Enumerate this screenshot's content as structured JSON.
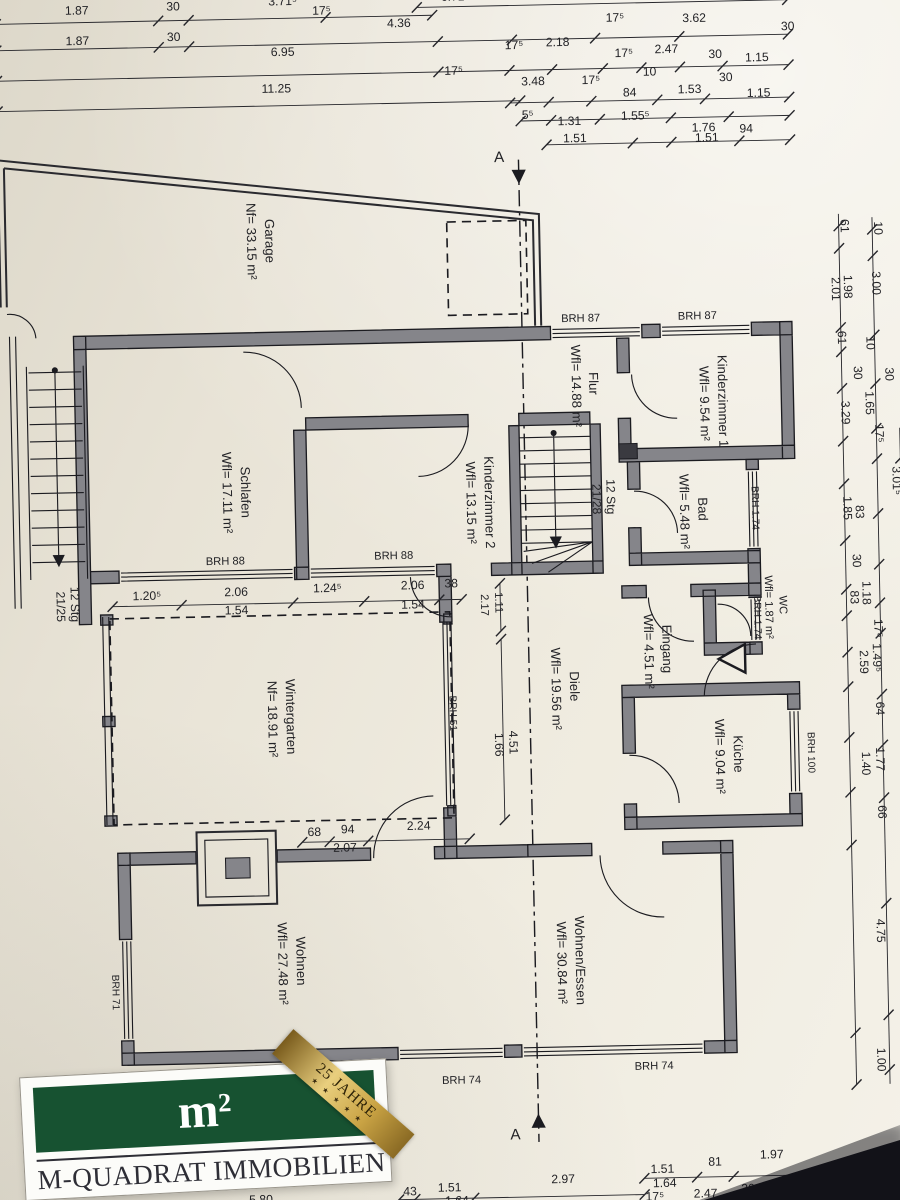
{
  "meta": {
    "paper_color": "#efebdf",
    "ink_color": "#1b1b20",
    "wall_fill": "#85858a",
    "corner_shadow": "#121218",
    "logo_green": "#175231",
    "logo_gold": "#c9a344"
  },
  "logo": {
    "m": "m",
    "sup": "2",
    "company": "M-QUADRAT IMMOBILIEN",
    "ribbon_line1": "25 JAHRE",
    "ribbon_stars": "★ ★ ★ ★ ★"
  },
  "rooms": [
    {
      "name": "Garage",
      "area": "Nf= 33.15 m²"
    },
    {
      "name": "Schlafen",
      "area": "Wfl= 17.11 m²"
    },
    {
      "name": "Kinderzimmer 2",
      "area": "Wfl= 13.15 m²"
    },
    {
      "name": "Kinderzimmer 1",
      "area": "Wfl= 9.54 m²"
    },
    {
      "name": "Flur",
      "area": "Wfl= 14.88 m²"
    },
    {
      "name": "Bad",
      "area": "Wfl= 5.48 m²"
    },
    {
      "name": "WC",
      "area": "Wfl= 1.87 m²"
    },
    {
      "name": "Eingang",
      "area": "Wfl= 4.51 m²"
    },
    {
      "name": "Diele",
      "area": "Wfl= 19.56 m²"
    },
    {
      "name": "Küche",
      "area": "Wfl= 9.04 m²"
    },
    {
      "name": "Wintergarten",
      "area": "Nf= 18.91 m²"
    },
    {
      "name": "Wohnen",
      "area": "Wfl= 27.48 m²"
    },
    {
      "name": "Wohnen/Essen",
      "area": "Wfl= 30.84 m²"
    }
  ],
  "stairs": [
    {
      "label": "12 Stg",
      "ratio": "21/25"
    },
    {
      "label": "12 Stg",
      "ratio": "21/28"
    }
  ],
  "section_marker": "A",
  "annotations": [
    [
      "dim-top",
      "1.87",
      95,
      16
    ],
    [
      "dim-top",
      "30",
      190,
      14
    ],
    [
      "dim-top",
      "3.71⁵",
      298,
      11
    ],
    [
      "dim-top",
      "17⁵",
      336,
      21
    ],
    [
      "dim-top",
      "6.71⁵",
      468,
      10
    ],
    [
      "dim-top",
      "3.62",
      665,
      7
    ],
    [
      "dim-top",
      "1.87",
      95,
      46
    ],
    [
      "dim-top",
      "30",
      190,
      44
    ],
    [
      "dim-top",
      "4.36",
      412,
      35
    ],
    [
      "dim-top",
      "17⁵",
      625,
      34
    ],
    [
      "dim-top",
      "3.62",
      703,
      36
    ],
    [
      "dim-top",
      "30",
      795,
      46
    ],
    [
      "dim-top",
      "6.95",
      297,
      61
    ],
    [
      "dim-top",
      "17⁵",
      525,
      59
    ],
    [
      "dim-top",
      "2.18",
      568,
      57
    ],
    [
      "dim-top",
      "17⁵",
      633,
      69
    ],
    [
      "dim-top",
      "2.47",
      675,
      66
    ],
    [
      "dim-top",
      "30",
      723,
      72
    ],
    [
      "dim-top",
      "1.15",
      764,
      76
    ],
    [
      "dim-top",
      "17⁵",
      465,
      83
    ],
    [
      "dim-top",
      "3.48",
      543,
      95
    ],
    [
      "dim-top",
      "17⁵",
      600,
      95
    ],
    [
      "dim-top",
      "10",
      658,
      88
    ],
    [
      "dim-top",
      "84",
      638,
      108
    ],
    [
      "dim-top",
      "1.53",
      697,
      106
    ],
    [
      "dim-top",
      "30",
      733,
      95
    ],
    [
      "dim-top",
      "1.15",
      765,
      111
    ],
    [
      "dim-top",
      "11.25",
      290,
      97
    ],
    [
      "dim-top",
      "5⁵",
      537,
      128
    ],
    [
      "dim-top",
      "1.31",
      578,
      135
    ],
    [
      "dim-top",
      "1.55⁵",
      643,
      131
    ],
    [
      "dim-top",
      "1.76",
      710,
      144
    ],
    [
      "dim-top",
      "94",
      752,
      146
    ],
    [
      "dim-top",
      "1.51",
      583,
      152
    ],
    [
      "dim-top",
      "1.51",
      713,
      154
    ],
    [
      "dim-right",
      "61",
      843,
      240,
      90
    ],
    [
      "dim-right",
      "10",
      876,
      243,
      90
    ],
    [
      "dim-right",
      "2.01",
      833,
      302,
      90
    ],
    [
      "dim-right",
      "1.98",
      845,
      300,
      90
    ],
    [
      "dim-right",
      "3.00",
      873,
      297,
      90
    ],
    [
      "dim-right",
      "61",
      838,
      350,
      90
    ],
    [
      "dim-right",
      "10",
      866,
      356,
      90
    ],
    [
      "dim-right",
      "30",
      853,
      385,
      90
    ],
    [
      "dim-right",
      "30",
      884,
      387,
      90
    ],
    [
      "dim-right",
      "3.29",
      840,
      424,
      90
    ],
    [
      "dim-right",
      "1.65",
      864,
      415,
      90
    ],
    [
      "dim-right",
      "17⁵",
      873,
      445,
      90
    ],
    [
      "dim-right",
      "3.01⁵",
      889,
      492,
      90
    ],
    [
      "dim-right",
      "1.85",
      840,
      518,
      90
    ],
    [
      "dim-right",
      "83",
      852,
      522,
      90
    ],
    [
      "dim-right",
      "30",
      848,
      570,
      90
    ],
    [
      "dim-right",
      "1.18",
      857,
      602,
      90
    ],
    [
      "dim-right",
      "83",
      845,
      606,
      90
    ],
    [
      "dim-right",
      "17⁵",
      868,
      637,
      90
    ],
    [
      "dim-right",
      "2.59",
      853,
      670,
      90
    ],
    [
      "dim-right",
      "1.49⁵",
      866,
      666,
      90
    ],
    [
      "dim-right",
      "3.02",
      897,
      700,
      90
    ],
    [
      "dim-right",
      "64",
      868,
      716,
      90
    ],
    [
      "dim-right",
      "1.40",
      853,
      770,
      90
    ],
    [
      "dim-right",
      "1.77",
      867,
      766,
      90
    ],
    [
      "dim-right",
      "66",
      868,
      818,
      90
    ],
    [
      "dim-right",
      "4.75",
      864,
      935,
      90
    ],
    [
      "dim-right",
      "4.45",
      894,
      922,
      90
    ],
    [
      "dim-right",
      "30",
      893,
      1012,
      90
    ],
    [
      "dim-right",
      "1.00",
      862,
      1062,
      90
    ],
    [
      "dim-right",
      "1.00",
      896,
      1068,
      90
    ],
    [
      "dim-bottom",
      "5.80",
      252,
      1191
    ],
    [
      "dim-bottom",
      "43",
      399,
      1186
    ],
    [
      "dim-bottom",
      "1.51",
      438,
      1183
    ],
    [
      "dim-bottom",
      "2.97",
      550,
      1177
    ],
    [
      "dim-bottom",
      "1.64",
      445,
      1196
    ],
    [
      "dim-bottom",
      "1.51",
      648,
      1169
    ],
    [
      "dim-bottom",
      "81",
      700,
      1163
    ],
    [
      "dim-bottom",
      "1.97",
      756,
      1157
    ],
    [
      "dim-bottom",
      "1.64",
      650,
      1183
    ],
    [
      "dim-bottom",
      "17⁵",
      640,
      1196
    ],
    [
      "dim-bottom",
      "2.47",
      690,
      1194
    ],
    [
      "dim-bottom",
      "30",
      732,
      1190
    ],
    [
      "dim-bottom",
      "1.15",
      770,
      1187
    ],
    [
      "window-label",
      "BRH 87",
      585,
      329,
      0,
      11
    ],
    [
      "window-label",
      "BRH 87",
      700,
      329,
      0,
      11
    ],
    [
      "window-label",
      "BRH 88",
      230,
      561,
      0,
      11
    ],
    [
      "window-label",
      "BRH 88",
      396,
      559,
      0,
      11
    ],
    [
      "window-label",
      "BRH 74",
      452,
      1077,
      0,
      11
    ],
    [
      "window-label",
      "BRH 74",
      642,
      1067,
      0,
      11
    ],
    [
      "window-label",
      "BRH 71",
      110,
      980,
      90,
      10
    ],
    [
      "window-label",
      "BRH 51",
      448,
      712,
      90,
      10
    ],
    [
      "window-label",
      "BRH 100",
      800,
      758,
      90,
      10
    ],
    [
      "window-label",
      "BRH 1.74",
      750,
      516,
      90,
      10
    ],
    [
      "window-label",
      "BRH 1.74",
      750,
      624,
      90,
      10
    ],
    [
      "dim-inner",
      "1.20⁵",
      152,
      594
    ],
    [
      "dim-inner",
      "2.06",
      240,
      592
    ],
    [
      "dim-inner",
      "1.24⁵",
      330,
      590
    ],
    [
      "dim-inner",
      "2.06",
      414,
      589
    ],
    [
      "dim-inner",
      "38",
      452,
      588
    ],
    [
      "dim-inner",
      "1.54",
      240,
      610
    ],
    [
      "dim-inner",
      "1.54",
      414,
      608
    ],
    [
      "dim-inner",
      "68",
      312,
      830
    ],
    [
      "dim-inner",
      "94",
      345,
      828
    ],
    [
      "dim-inner",
      "2.24",
      415,
      826
    ],
    [
      "dim-inner",
      "2.07",
      342,
      846
    ],
    [
      "dim-inner",
      "1.11",
      495,
      604,
      90,
      11
    ],
    [
      "dim-inner",
      "2.17",
      481,
      606,
      90,
      11
    ],
    [
      "dim-inner",
      "4.51",
      506,
      742,
      90
    ],
    [
      "dim-inner",
      "1.66",
      492,
      744,
      90
    ],
    [
      "room-label",
      "Garage",
      276,
      243,
      90,
      13
    ],
    [
      "room-label",
      "Nf= 33.15 m²",
      258,
      243,
      90,
      13
    ],
    [
      "room-label",
      "Schlafen",
      247,
      490,
      90,
      13
    ],
    [
      "room-label",
      "Wfl= 17.11 m²",
      229,
      490,
      90,
      13
    ],
    [
      "room-label",
      "Kinderzimmer 2",
      487,
      505,
      90,
      13
    ],
    [
      "room-label",
      "Wfl= 13.15 m²",
      469,
      505,
      90,
      13
    ],
    [
      "room-label",
      "Flur",
      592,
      390,
      90,
      13
    ],
    [
      "room-label",
      "Wfl= 14.88 m²",
      575,
      392,
      90,
      13
    ],
    [
      "room-label",
      "Kinderzimmer 1",
      719,
      410,
      90,
      13
    ],
    [
      "room-label",
      "Wfl= 9.54 m²",
      701,
      412,
      90,
      13
    ],
    [
      "room-label",
      "Bad",
      697,
      516,
      90,
      13
    ],
    [
      "room-label",
      "Wfl= 5.48 m²",
      679,
      518,
      90,
      13
    ],
    [
      "room-label",
      "WC",
      775,
      612,
      90,
      11
    ],
    [
      "room-label",
      "Wfl= 1.87 m²",
      761,
      614,
      90,
      11
    ],
    [
      "room-label",
      "Eingang",
      659,
      653,
      90,
      13
    ],
    [
      "room-label",
      "Wfl= 4.51 m²",
      641,
      655,
      90,
      13
    ],
    [
      "room-label",
      "Diele",
      567,
      688,
      90,
      13
    ],
    [
      "room-label",
      "Wfl= 19.56 m²",
      549,
      690,
      90,
      13
    ],
    [
      "room-label",
      "Küche",
      727,
      758,
      90,
      13
    ],
    [
      "room-label",
      "Wfl= 9.04 m²",
      709,
      760,
      90,
      13
    ],
    [
      "room-label",
      "Wintergarten",
      287,
      712,
      90,
      13
    ],
    [
      "room-label",
      "Nf= 18.91 m²",
      269,
      714,
      90,
      13
    ],
    [
      "room-label",
      "Wohnen",
      292,
      953,
      90,
      13
    ],
    [
      "room-label",
      "Wfl= 27.48 m²",
      274,
      955,
      90,
      13
    ],
    [
      "room-label",
      "Wohnen/Essen",
      567,
      958,
      90,
      13
    ],
    [
      "room-label",
      "Wfl= 30.84 m²",
      549,
      960,
      90,
      13
    ],
    [
      "stair-label",
      "12 Stg",
      607,
      502,
      90,
      12
    ],
    [
      "stair-label",
      "21/28",
      593,
      504,
      90,
      12
    ],
    [
      "stair-label",
      "12 Stg",
      77,
      597,
      90,
      12
    ],
    [
      "stair-label",
      "21/25",
      63,
      599,
      90,
      12
    ],
    [
      "section-label",
      "A",
      508,
      170,
      0,
      15
    ],
    [
      "section-label",
      "A",
      504,
      1133,
      0,
      15
    ]
  ]
}
